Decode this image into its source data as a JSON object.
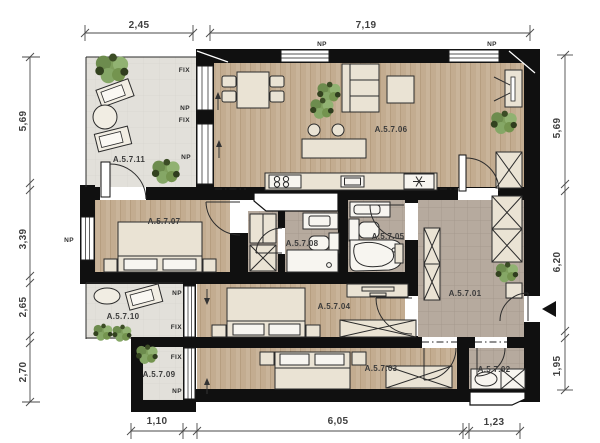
{
  "plan": {
    "type": "apartment-floor-plan",
    "colors": {
      "wall": "#101010",
      "wood_floor": "#c9b49a",
      "tile_floor": "#b5a99d",
      "balcony_floor": "#e2e0da",
      "furniture": "#eae3d4",
      "plant": "#7f9f5d",
      "text": "#3b3b3b"
    },
    "rooms": [
      {
        "label": "A.5.7.01"
      },
      {
        "label": "A.5.7.02"
      },
      {
        "label": "A.5.7.03"
      },
      {
        "label": "A.5.7.04"
      },
      {
        "label": "A.5.7.05"
      },
      {
        "label": "A.5.7.06"
      },
      {
        "label": "A.5.7.07"
      },
      {
        "label": "A.5.7.08"
      },
      {
        "label": "A.5.7.09"
      },
      {
        "label": "A.5.7.10"
      },
      {
        "label": "A.5.7.11"
      }
    ],
    "openings": {
      "np": "NP",
      "fix": "FIX"
    },
    "dims": {
      "top": [
        "2,45",
        "7,19"
      ],
      "bottom": [
        "1,10",
        "6,05",
        "1,23"
      ],
      "left": [
        "5,69",
        "3,39",
        "2,65",
        "2,70"
      ],
      "right": [
        "5,69",
        "6,20",
        "1,95"
      ]
    }
  }
}
